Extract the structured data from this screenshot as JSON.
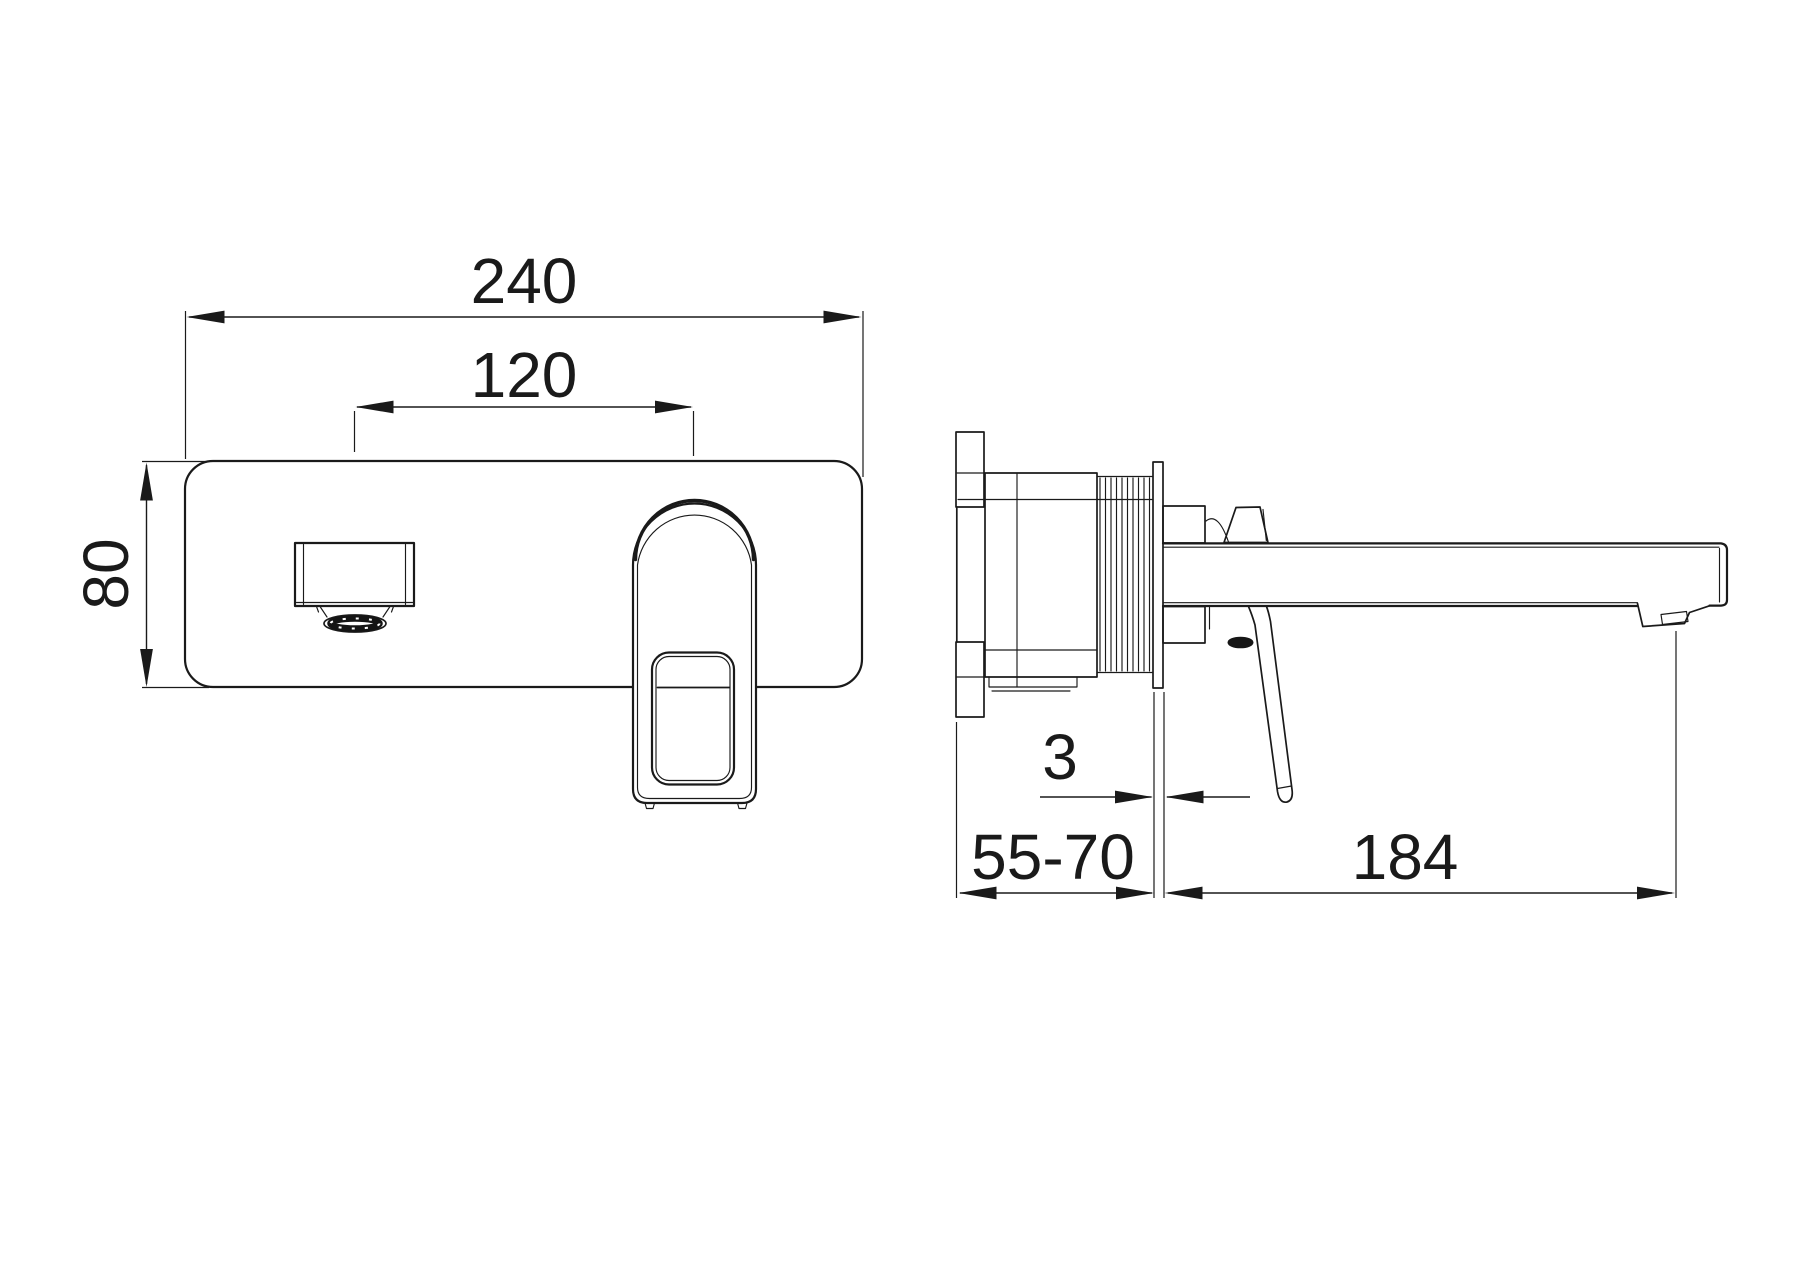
{
  "drawing": {
    "background_color": "#ffffff",
    "line_color": "#1a1a1a",
    "dims": {
      "plate_width": "240",
      "hole_centers": "120",
      "plate_height": "80",
      "trim_plate_thickness": "3",
      "installation_depth_range": "55-70",
      "spout_reach": "184"
    }
  }
}
